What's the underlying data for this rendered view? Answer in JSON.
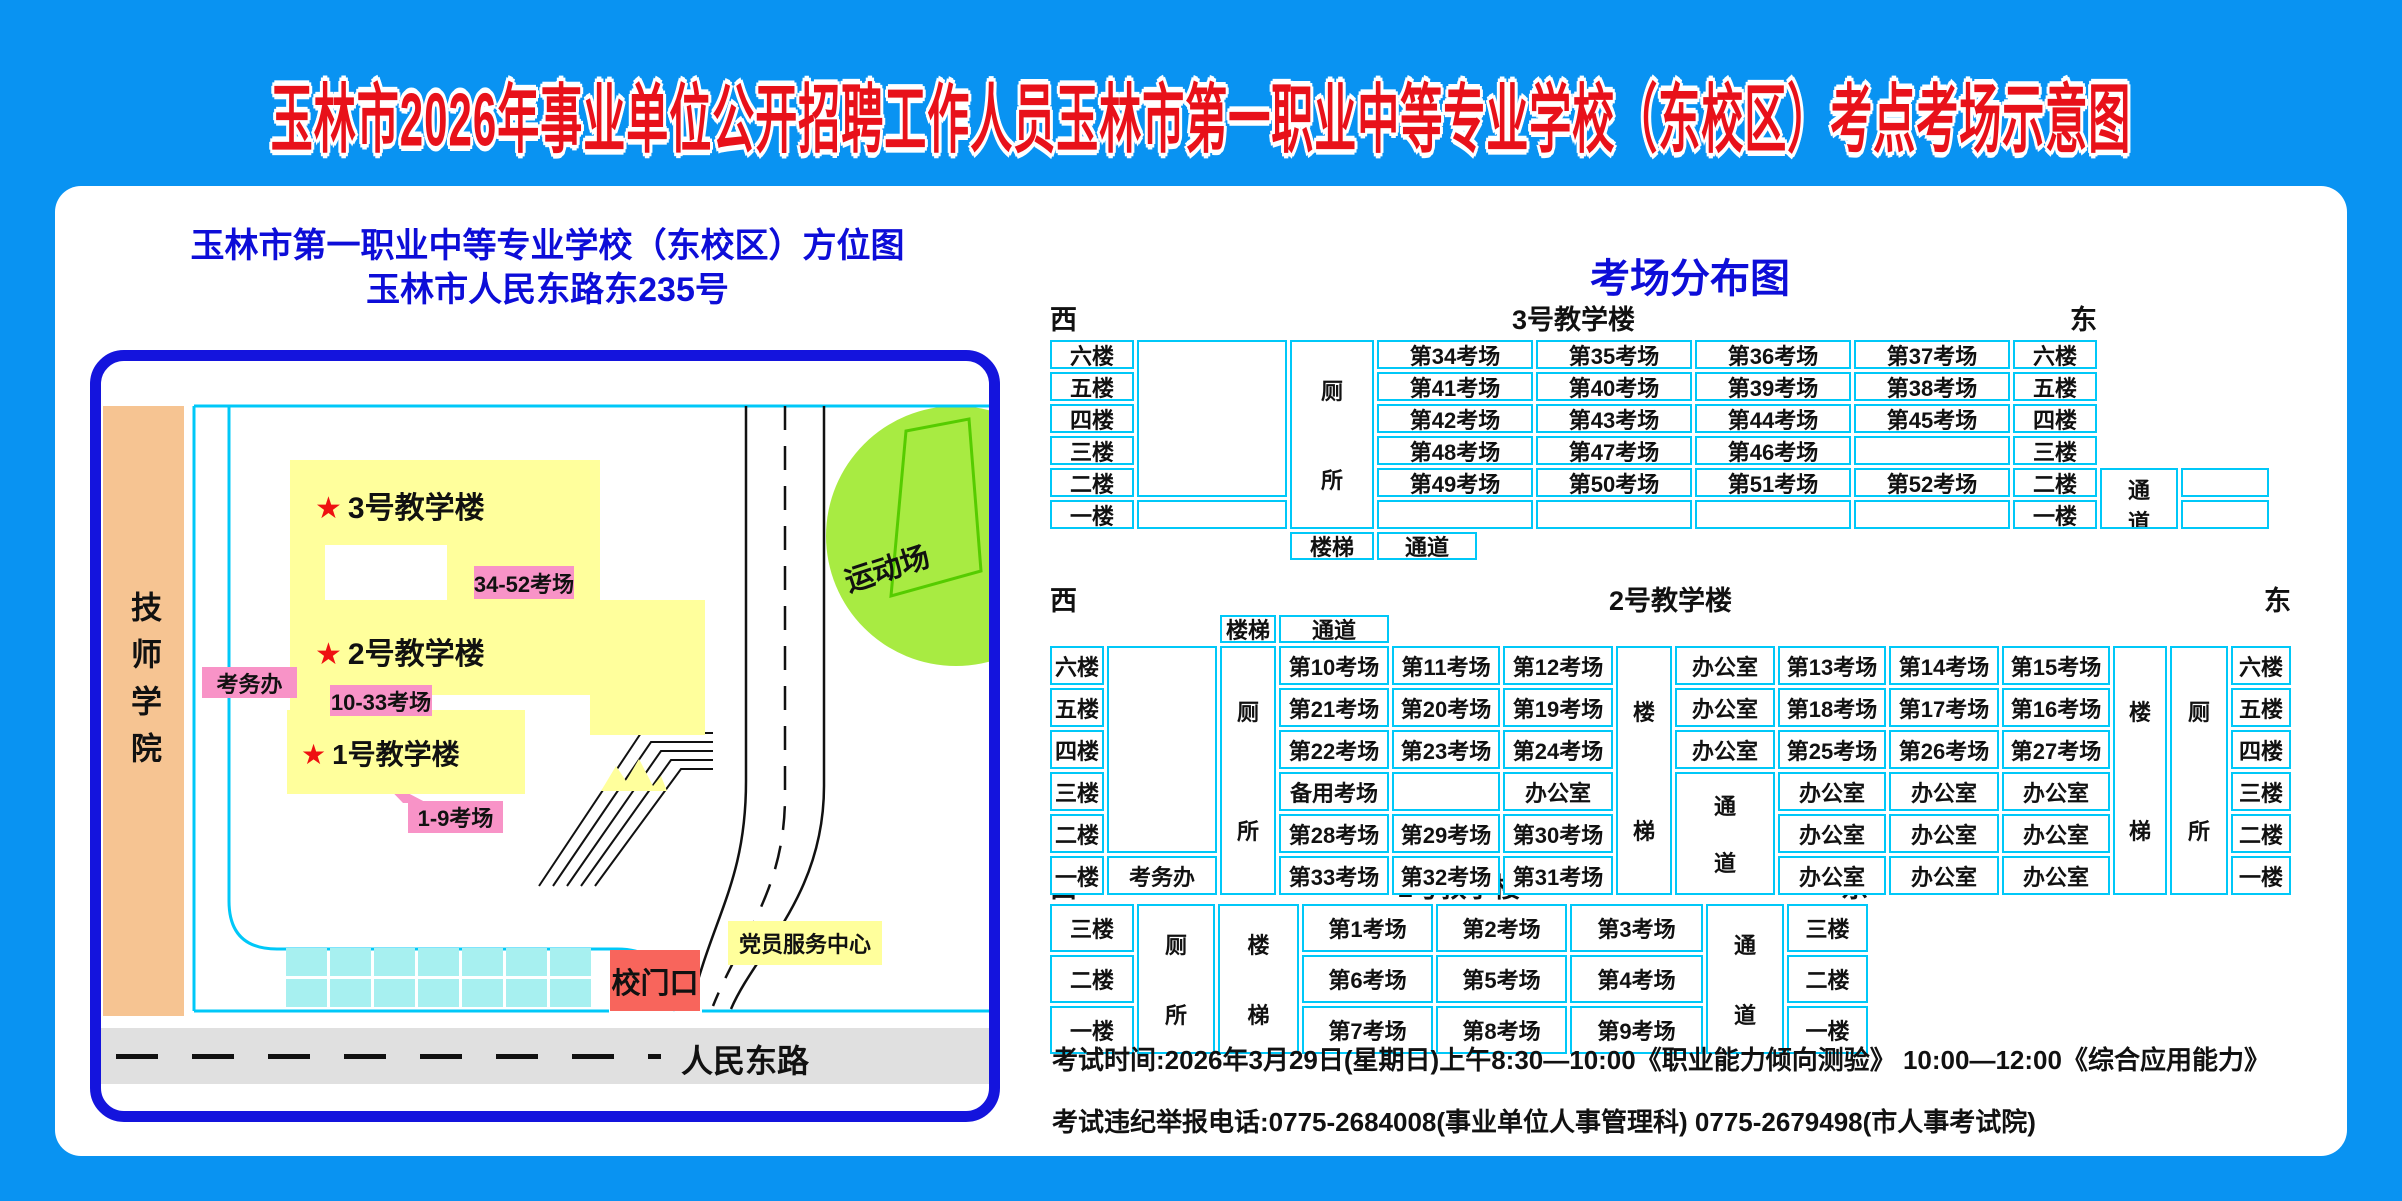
{
  "title": "玉林市2026年事业单位公开招聘工作人员玉林市第一职业中等专业学校（东校区）考点考场示意图",
  "colors": {
    "background_blue": "#0993f2",
    "card_white": "#ffffff",
    "title_red": "#e8111a",
    "heading_blue": "#0d0dd8",
    "map_border_blue": "#1414dd",
    "table_border_cyan": "#00c8f8",
    "building_yellow": "#ffff9c",
    "callout_pink": "#f893c7",
    "college_orange": "#f6c492",
    "sport_green": "#a8eb42",
    "parking_cyan": "#a7f0f0",
    "gate_red": "#f8655c",
    "road_gray": "#e0e0e0"
  },
  "map": {
    "title_line1": "玉林市第一职业中等专业学校（东校区）方位图",
    "title_line2": "玉林市人民东路东235号",
    "college": "技师学院",
    "star": "★",
    "building3": "3号教学楼",
    "building2": "2号教学楼",
    "building1": "1号教学楼",
    "callout3": "34-52考场",
    "callout2": "10-33考场",
    "callout1": "1-9考场",
    "kaowuban": "考务办",
    "sport": "运动场",
    "gate": "校门口",
    "party": "党员服务中心",
    "road": "人民东路",
    "parking": {
      "rows": 2,
      "cols": 7
    }
  },
  "right": {
    "title": "考场分布图",
    "west": "西",
    "east": "东",
    "sections": [
      {
        "label": "3号教学楼"
      },
      {
        "label": "2号教学楼"
      },
      {
        "label": "1号教学楼"
      }
    ],
    "note1": "考试时间:2026年3月29日(星期日)上午8:30—10:00《职业能力倾向测验》      10:00—12:00《综合应用能力》",
    "note2": "考试违纪举报电话:0775-2684008(事业单位人事管理科)  0775-2679498(市人事考试院)"
  },
  "tables": [
    {
      "id": "t3",
      "left": 1050,
      "top": 340,
      "cols": [
        84,
        150,
        84,
        156,
        156,
        156,
        156,
        84,
        78,
        88
      ],
      "rows": [
        29,
        29,
        29,
        29,
        29,
        29,
        28
      ],
      "cells": [
        {
          "r": 1,
          "c": 1,
          "t": "六楼"
        },
        {
          "r": 2,
          "c": 1,
          "t": "五楼"
        },
        {
          "r": 3,
          "c": 1,
          "t": "四楼"
        },
        {
          "r": 4,
          "c": 1,
          "t": "三楼"
        },
        {
          "r": 5,
          "c": 1,
          "t": "二楼"
        },
        {
          "r": 6,
          "c": 1,
          "t": "一楼"
        },
        {
          "r": 1,
          "c": 2,
          "rs": 5,
          "t": ""
        },
        {
          "r": 6,
          "c": 2,
          "t": ""
        },
        {
          "r": 1,
          "c": 3,
          "rs": 6,
          "t": "厕所",
          "v": 1
        },
        {
          "r": 1,
          "c": 4,
          "t": "第34考场"
        },
        {
          "r": 1,
          "c": 5,
          "t": "第35考场"
        },
        {
          "r": 1,
          "c": 6,
          "t": "第36考场"
        },
        {
          "r": 1,
          "c": 7,
          "t": "第37考场"
        },
        {
          "r": 2,
          "c": 4,
          "t": "第41考场"
        },
        {
          "r": 2,
          "c": 5,
          "t": "第40考场"
        },
        {
          "r": 2,
          "c": 6,
          "t": "第39考场"
        },
        {
          "r": 2,
          "c": 7,
          "t": "第38考场"
        },
        {
          "r": 3,
          "c": 4,
          "t": "第42考场"
        },
        {
          "r": 3,
          "c": 5,
          "t": "第43考场"
        },
        {
          "r": 3,
          "c": 6,
          "t": "第44考场"
        },
        {
          "r": 3,
          "c": 7,
          "t": "第45考场"
        },
        {
          "r": 4,
          "c": 4,
          "t": "第48考场"
        },
        {
          "r": 4,
          "c": 5,
          "t": "第47考场"
        },
        {
          "r": 4,
          "c": 6,
          "t": "第46考场"
        },
        {
          "r": 4,
          "c": 7,
          "t": ""
        },
        {
          "r": 5,
          "c": 4,
          "t": "第49考场"
        },
        {
          "r": 5,
          "c": 5,
          "t": "第50考场"
        },
        {
          "r": 5,
          "c": 6,
          "t": "第51考场"
        },
        {
          "r": 5,
          "c": 7,
          "t": "第52考场"
        },
        {
          "r": 6,
          "c": 4,
          "t": ""
        },
        {
          "r": 6,
          "c": 5,
          "t": ""
        },
        {
          "r": 6,
          "c": 6,
          "t": ""
        },
        {
          "r": 6,
          "c": 7,
          "t": ""
        },
        {
          "r": 1,
          "c": 8,
          "t": "六楼"
        },
        {
          "r": 2,
          "c": 8,
          "t": "五楼"
        },
        {
          "r": 3,
          "c": 8,
          "t": "四楼"
        },
        {
          "r": 4,
          "c": 8,
          "t": "三楼"
        },
        {
          "r": 5,
          "c": 8,
          "t": "二楼"
        },
        {
          "r": 6,
          "c": 8,
          "t": "一楼"
        },
        {
          "r": 5,
          "c": 9,
          "rs": 2,
          "t": "通道",
          "v": 1
        },
        {
          "r": 5,
          "c": 10,
          "t": ""
        },
        {
          "r": 6,
          "c": 10,
          "t": ""
        },
        {
          "r": 7,
          "c": 3,
          "t": "楼梯"
        },
        {
          "r": 7,
          "c": 4,
          "t": "通道",
          "w": 100
        }
      ]
    },
    {
      "id": "t2",
      "left": 1050,
      "top": 615,
      "cols": [
        54,
        110,
        56,
        110,
        108,
        110,
        56,
        100,
        108,
        110,
        108,
        54,
        58,
        60
      ],
      "rows": [
        28,
        39,
        39,
        39,
        39,
        39,
        39
      ],
      "cells": [
        {
          "r": 1,
          "c": 3,
          "t": "楼梯"
        },
        {
          "r": 1,
          "c": 4,
          "t": "通道"
        },
        {
          "r": 2,
          "c": 1,
          "t": "六楼"
        },
        {
          "r": 3,
          "c": 1,
          "t": "五楼"
        },
        {
          "r": 4,
          "c": 1,
          "t": "四楼"
        },
        {
          "r": 5,
          "c": 1,
          "t": "三楼"
        },
        {
          "r": 6,
          "c": 1,
          "t": "二楼"
        },
        {
          "r": 7,
          "c": 1,
          "t": "一楼"
        },
        {
          "r": 2,
          "c": 2,
          "rs": 5,
          "t": ""
        },
        {
          "r": 7,
          "c": 2,
          "t": "考务办"
        },
        {
          "r": 2,
          "c": 3,
          "rs": 6,
          "t": "厕所",
          "v": 1
        },
        {
          "r": 2,
          "c": 4,
          "t": "第10考场"
        },
        {
          "r": 2,
          "c": 5,
          "t": "第11考场"
        },
        {
          "r": 2,
          "c": 6,
          "t": "第12考场"
        },
        {
          "r": 3,
          "c": 4,
          "t": "第21考场"
        },
        {
          "r": 3,
          "c": 5,
          "t": "第20考场"
        },
        {
          "r": 3,
          "c": 6,
          "t": "第19考场"
        },
        {
          "r": 4,
          "c": 4,
          "t": "第22考场"
        },
        {
          "r": 4,
          "c": 5,
          "t": "第23考场"
        },
        {
          "r": 4,
          "c": 6,
          "t": "第24考场"
        },
        {
          "r": 5,
          "c": 4,
          "t": "备用考场"
        },
        {
          "r": 5,
          "c": 5,
          "t": ""
        },
        {
          "r": 5,
          "c": 6,
          "t": "办公室"
        },
        {
          "r": 6,
          "c": 4,
          "t": "第28考场"
        },
        {
          "r": 6,
          "c": 5,
          "t": "第29考场"
        },
        {
          "r": 6,
          "c": 6,
          "t": "第30考场"
        },
        {
          "r": 7,
          "c": 4,
          "t": "第33考场"
        },
        {
          "r": 7,
          "c": 5,
          "t": "第32考场"
        },
        {
          "r": 7,
          "c": 6,
          "t": "第31考场"
        },
        {
          "r": 2,
          "c": 7,
          "rs": 6,
          "t": "楼梯",
          "v": 1
        },
        {
          "r": 2,
          "c": 8,
          "t": "办公室"
        },
        {
          "r": 3,
          "c": 8,
          "t": "办公室"
        },
        {
          "r": 4,
          "c": 8,
          "t": "办公室"
        },
        {
          "r": 5,
          "c": 8,
          "rs": 3,
          "t": "通道",
          "v": 1
        },
        {
          "r": 2,
          "c": 9,
          "t": "第13考场"
        },
        {
          "r": 2,
          "c": 10,
          "t": "第14考场"
        },
        {
          "r": 2,
          "c": 11,
          "t": "第15考场"
        },
        {
          "r": 3,
          "c": 9,
          "t": "第18考场"
        },
        {
          "r": 3,
          "c": 10,
          "t": "第17考场"
        },
        {
          "r": 3,
          "c": 11,
          "t": "第16考场"
        },
        {
          "r": 4,
          "c": 9,
          "t": "第25考场"
        },
        {
          "r": 4,
          "c": 10,
          "t": "第26考场"
        },
        {
          "r": 4,
          "c": 11,
          "t": "第27考场"
        },
        {
          "r": 5,
          "c": 9,
          "t": "办公室"
        },
        {
          "r": 5,
          "c": 10,
          "t": "办公室"
        },
        {
          "r": 5,
          "c": 11,
          "t": "办公室"
        },
        {
          "r": 6,
          "c": 9,
          "t": "办公室"
        },
        {
          "r": 6,
          "c": 10,
          "t": "办公室"
        },
        {
          "r": 6,
          "c": 11,
          "t": "办公室"
        },
        {
          "r": 7,
          "c": 9,
          "t": "办公室"
        },
        {
          "r": 7,
          "c": 10,
          "t": "办公室"
        },
        {
          "r": 7,
          "c": 11,
          "t": "办公室"
        },
        {
          "r": 2,
          "c": 12,
          "rs": 6,
          "t": "楼梯",
          "v": 1
        },
        {
          "r": 2,
          "c": 13,
          "rs": 6,
          "t": "厕所",
          "v": 1
        },
        {
          "r": 2,
          "c": 14,
          "t": "六楼"
        },
        {
          "r": 3,
          "c": 14,
          "t": "五楼"
        },
        {
          "r": 4,
          "c": 14,
          "t": "四楼"
        },
        {
          "r": 5,
          "c": 14,
          "t": "三楼"
        },
        {
          "r": 6,
          "c": 14,
          "t": "二楼"
        },
        {
          "r": 7,
          "c": 14,
          "t": "一楼"
        }
      ]
    },
    {
      "id": "t1",
      "left": 1050,
      "top": 904,
      "cols": [
        84,
        78,
        81,
        131,
        131,
        133,
        78,
        81
      ],
      "rows": [
        48,
        48,
        48
      ],
      "cells": [
        {
          "r": 1,
          "c": 1,
          "t": "三楼"
        },
        {
          "r": 2,
          "c": 1,
          "t": "二楼"
        },
        {
          "r": 3,
          "c": 1,
          "t": "一楼"
        },
        {
          "r": 1,
          "c": 2,
          "rs": 3,
          "t": "厕所",
          "v": 1
        },
        {
          "r": 1,
          "c": 3,
          "rs": 3,
          "t": "楼梯",
          "v": 1
        },
        {
          "r": 1,
          "c": 4,
          "t": "第1考场"
        },
        {
          "r": 1,
          "c": 5,
          "t": "第2考场"
        },
        {
          "r": 1,
          "c": 6,
          "t": "第3考场"
        },
        {
          "r": 2,
          "c": 4,
          "t": "第6考场"
        },
        {
          "r": 2,
          "c": 5,
          "t": "第5考场"
        },
        {
          "r": 2,
          "c": 6,
          "t": "第4考场"
        },
        {
          "r": 3,
          "c": 4,
          "t": "第7考场"
        },
        {
          "r": 3,
          "c": 5,
          "t": "第8考场"
        },
        {
          "r": 3,
          "c": 6,
          "t": "第9考场"
        },
        {
          "r": 1,
          "c": 7,
          "rs": 3,
          "t": "通道",
          "v": 1
        },
        {
          "r": 1,
          "c": 8,
          "t": "三楼"
        },
        {
          "r": 2,
          "c": 8,
          "t": "二楼"
        },
        {
          "r": 3,
          "c": 8,
          "t": "一楼"
        }
      ]
    }
  ],
  "section_headers": [
    {
      "left": 1050,
      "top": 298,
      "width": 1047,
      "section": 0
    },
    {
      "left": 1050,
      "top": 579,
      "width": 1241,
      "section": 1
    },
    {
      "left": 1050,
      "top": 866,
      "width": 818,
      "section": 2
    }
  ]
}
